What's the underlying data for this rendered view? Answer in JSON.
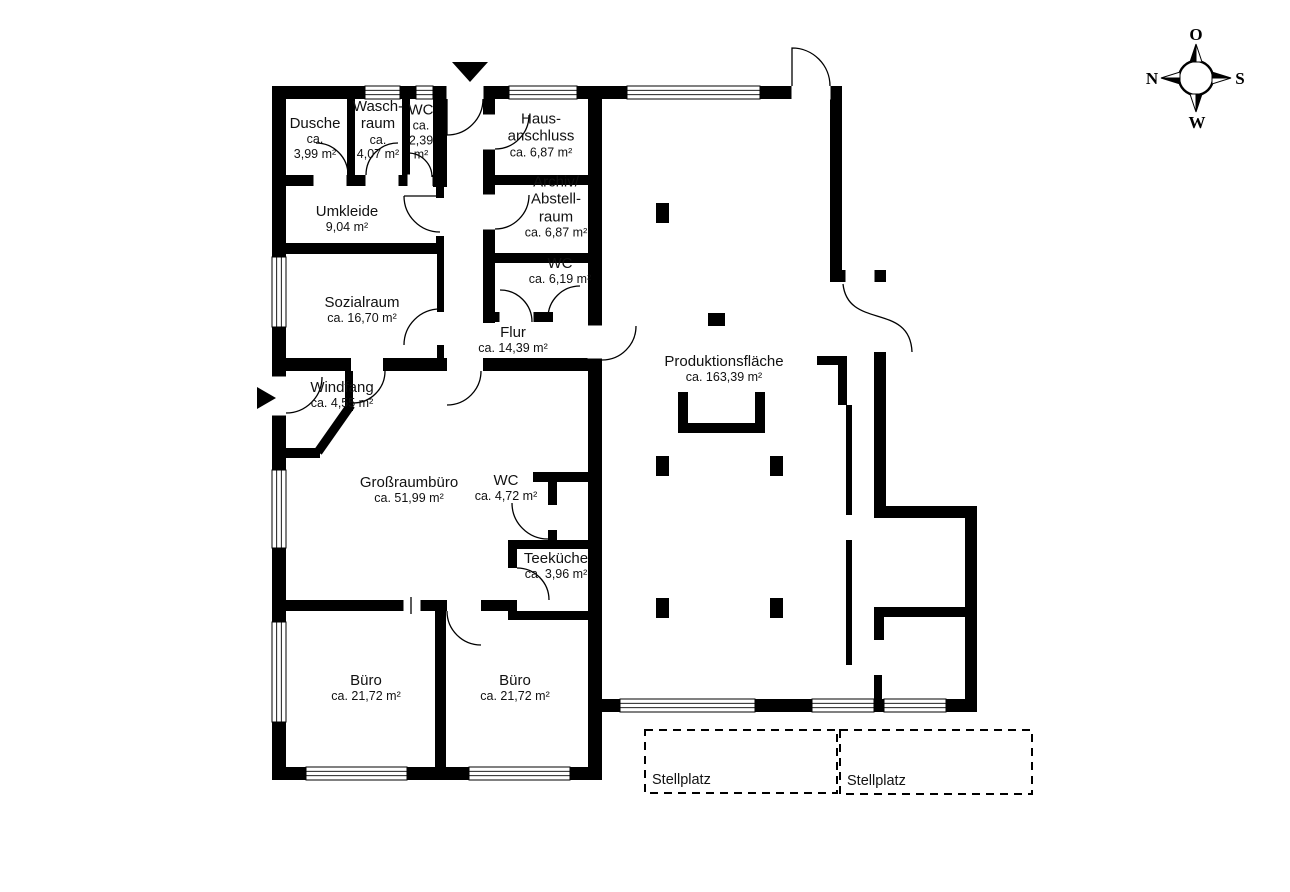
{
  "plan": {
    "colors": {
      "bg": "#ffffff",
      "wall": "#000000",
      "line": "#000000"
    },
    "walls": [
      {
        "x": 272,
        "y": 86,
        "w": 330,
        "h": 13
      },
      {
        "x": 602,
        "y": 86,
        "w": 190,
        "h": 13
      },
      {
        "x": 272,
        "y": 86,
        "w": 14,
        "h": 694
      },
      {
        "x": 272,
        "y": 767,
        "w": 330,
        "h": 13
      },
      {
        "x": 588,
        "y": 86,
        "w": 14,
        "h": 694
      },
      {
        "x": 596,
        "y": 699,
        "w": 381,
        "h": 13
      },
      {
        "x": 830,
        "y": 86,
        "w": 12,
        "h": 196
      },
      {
        "x": 830,
        "y": 270,
        "w": 56,
        "h": 12
      },
      {
        "x": 874,
        "y": 352,
        "w": 12,
        "h": 166
      },
      {
        "x": 874,
        "y": 506,
        "w": 103,
        "h": 12
      },
      {
        "x": 965,
        "y": 506,
        "w": 12,
        "h": 206
      },
      {
        "x": 347,
        "y": 99,
        "w": 8,
        "h": 76
      },
      {
        "x": 402,
        "y": 99,
        "w": 8,
        "h": 76
      },
      {
        "x": 433,
        "y": 99,
        "w": 14,
        "h": 88
      },
      {
        "x": 272,
        "y": 175,
        "w": 175,
        "h": 11
      },
      {
        "x": 483,
        "y": 99,
        "w": 12,
        "h": 224
      },
      {
        "x": 495,
        "y": 175,
        "w": 93,
        "h": 10
      },
      {
        "x": 483,
        "y": 253,
        "w": 105,
        "h": 10
      },
      {
        "x": 483,
        "y": 312,
        "w": 70,
        "h": 10
      },
      {
        "x": 436,
        "y": 186,
        "w": 8,
        "h": 12
      },
      {
        "x": 436,
        "y": 236,
        "w": 8,
        "h": 18
      },
      {
        "x": 272,
        "y": 243,
        "w": 170,
        "h": 11
      },
      {
        "x": 437,
        "y": 254,
        "w": 7,
        "h": 58
      },
      {
        "x": 437,
        "y": 345,
        "w": 7,
        "h": 16
      },
      {
        "x": 272,
        "y": 358,
        "w": 79,
        "h": 13
      },
      {
        "x": 383,
        "y": 358,
        "w": 64,
        "h": 13
      },
      {
        "x": 483,
        "y": 358,
        "w": 119,
        "h": 13
      },
      {
        "x": 345,
        "y": 371,
        "w": 8,
        "h": 40
      },
      {
        "x": 286,
        "y": 448,
        "w": 34,
        "h": 10
      },
      {
        "x": 533,
        "y": 472,
        "w": 69,
        "h": 10
      },
      {
        "x": 548,
        "y": 472,
        "w": 9,
        "h": 33
      },
      {
        "x": 548,
        "y": 530,
        "w": 9,
        "h": 12
      },
      {
        "x": 508,
        "y": 540,
        "w": 94,
        "h": 9
      },
      {
        "x": 508,
        "y": 549,
        "w": 9,
        "h": 19
      },
      {
        "x": 508,
        "y": 600,
        "w": 9,
        "h": 20
      },
      {
        "x": 508,
        "y": 611,
        "w": 94,
        "h": 9
      },
      {
        "x": 286,
        "y": 600,
        "w": 161,
        "h": 11
      },
      {
        "x": 481,
        "y": 600,
        "w": 35,
        "h": 11
      },
      {
        "x": 435,
        "y": 611,
        "w": 11,
        "h": 156
      },
      {
        "x": 678,
        "y": 392,
        "w": 10,
        "h": 41
      },
      {
        "x": 678,
        "y": 423,
        "w": 87,
        "h": 10
      },
      {
        "x": 755,
        "y": 392,
        "w": 10,
        "h": 41
      },
      {
        "x": 817,
        "y": 356,
        "w": 30,
        "h": 9
      },
      {
        "x": 838,
        "y": 356,
        "w": 9,
        "h": 49
      },
      {
        "x": 846,
        "y": 405,
        "w": 6,
        "h": 110
      },
      {
        "x": 846,
        "y": 540,
        "w": 6,
        "h": 125
      },
      {
        "x": 874,
        "y": 607,
        "w": 103,
        "h": 10
      },
      {
        "x": 874,
        "y": 617,
        "w": 10,
        "h": 23
      },
      {
        "x": 874,
        "y": 675,
        "w": 8,
        "h": 26
      }
    ],
    "diagonal_walls": [
      {
        "x1": 351,
        "y1": 405,
        "x2": 318,
        "y2": 452,
        "t": 9
      }
    ],
    "openings": [
      {
        "x": 447,
        "y": 86,
        "w": 36,
        "h": 13
      },
      {
        "x": 792,
        "y": 86,
        "w": 38,
        "h": 13
      },
      {
        "x": 272,
        "y": 377,
        "w": 14,
        "h": 38
      },
      {
        "x": 588,
        "y": 326,
        "w": 14,
        "h": 32
      },
      {
        "x": 846,
        "y": 270,
        "w": 28,
        "h": 12
      },
      {
        "x": 314,
        "y": 175,
        "w": 32,
        "h": 11
      },
      {
        "x": 366,
        "y": 175,
        "w": 32,
        "h": 11
      },
      {
        "x": 408,
        "y": 175,
        "w": 24,
        "h": 11
      },
      {
        "x": 483,
        "y": 115,
        "w": 12,
        "h": 34
      },
      {
        "x": 483,
        "y": 195,
        "w": 12,
        "h": 34
      },
      {
        "x": 500,
        "y": 312,
        "w": 33,
        "h": 10
      },
      {
        "x": 404,
        "y": 600,
        "w": 16,
        "h": 11
      }
    ],
    "windows": [
      {
        "x": 365,
        "y": 86,
        "w": 35,
        "h": 13,
        "dir": "h"
      },
      {
        "x": 416,
        "y": 86,
        "w": 17,
        "h": 13,
        "dir": "h"
      },
      {
        "x": 509,
        "y": 86,
        "w": 68,
        "h": 13,
        "dir": "h"
      },
      {
        "x": 627,
        "y": 86,
        "w": 133,
        "h": 13,
        "dir": "h"
      },
      {
        "x": 272,
        "y": 257,
        "w": 14,
        "h": 70,
        "dir": "v"
      },
      {
        "x": 272,
        "y": 470,
        "w": 14,
        "h": 78,
        "dir": "v"
      },
      {
        "x": 272,
        "y": 622,
        "w": 14,
        "h": 100,
        "dir": "v"
      },
      {
        "x": 306,
        "y": 767,
        "w": 101,
        "h": 13,
        "dir": "h"
      },
      {
        "x": 469,
        "y": 767,
        "w": 101,
        "h": 13,
        "dir": "h"
      },
      {
        "x": 620,
        "y": 699,
        "w": 135,
        "h": 13,
        "dir": "h"
      },
      {
        "x": 812,
        "y": 699,
        "w": 62,
        "h": 13,
        "dir": "h"
      },
      {
        "x": 884,
        "y": 699,
        "w": 62,
        "h": 13,
        "dir": "h"
      }
    ],
    "doors": [
      {
        "d": "M 483 99 A 36 36 0 0 1 447 135 M 447 99 L 447 135"
      },
      {
        "d": "M 792 86 L 792 48 A 38 38 0 0 1 830 86"
      },
      {
        "d": "M 322 377 A 36 36 0 0 1 286 413"
      },
      {
        "d": "M 385 371 A 32 32 0 0 1 353 403"
      },
      {
        "d": "M 348 175 A 32 32 0 0 0 316 143"
      },
      {
        "d": "M 398 143 A 32 32 0 0 0 366 175"
      },
      {
        "d": "M 408 153 A 24 24 0 0 1 432 177"
      },
      {
        "d": "M 404 196 A 36 36 0 0 0 440 232 M 404 196 L 440 196"
      },
      {
        "d": "M 440 309 A 36 36 0 0 0 404 345"
      },
      {
        "d": "M 495 149 A 34 34 0 0 0 529 115"
      },
      {
        "d": "M 495 229 A 34 34 0 0 0 529 195"
      },
      {
        "d": "M 500 290 A 32 32 0 0 1 532 322"
      },
      {
        "d": "M 580 286 A 32 32 0 0 0 548 318"
      },
      {
        "d": "M 481 371 A 34 34 0 0 1 447 405"
      },
      {
        "d": "M 636 326 A 34 34 0 0 1 602 360"
      },
      {
        "d": "M 843 284 C 848 330 910 302 912 352"
      },
      {
        "d": "M 512 503 A 36 36 0 0 0 548 539"
      },
      {
        "d": "M 517 568 A 32 32 0 0 1 549 600"
      },
      {
        "d": "M 447 611 A 34 34 0 0 0 481 645"
      },
      {
        "d": "M 411 597 L 411 614"
      }
    ],
    "columns": [
      {
        "x": 656,
        "y": 203,
        "w": 13,
        "h": 20
      },
      {
        "x": 708,
        "y": 313,
        "w": 17,
        "h": 13
      },
      {
        "x": 656,
        "y": 456,
        "w": 13,
        "h": 20
      },
      {
        "x": 770,
        "y": 456,
        "w": 13,
        "h": 20
      },
      {
        "x": 656,
        "y": 598,
        "w": 13,
        "h": 20
      },
      {
        "x": 770,
        "y": 598,
        "w": 13,
        "h": 20
      }
    ],
    "entrance_arrows": [
      {
        "points": "452,62 488,62 470,82"
      },
      {
        "points": "257,387 276,398 257,409"
      }
    ],
    "stellplatz": [
      {
        "x": 645,
        "y": 730,
        "w": 192,
        "h": 63,
        "label": "Stellplatz"
      },
      {
        "x": 840,
        "y": 730,
        "w": 192,
        "h": 64,
        "label": "Stellplatz"
      }
    ]
  },
  "rooms": [
    {
      "id": "dusche",
      "cx": 315,
      "cy": 138,
      "name": [
        "Dusche"
      ],
      "area": [
        "ca.",
        "3,99 m²"
      ]
    },
    {
      "id": "waschraum",
      "cx": 378,
      "cy": 130,
      "name": [
        "Wasch-",
        "raum"
      ],
      "area": [
        "ca.",
        "4,07 m²"
      ]
    },
    {
      "id": "wc-klein",
      "cx": 421,
      "cy": 132,
      "name": [
        "WC"
      ],
      "area": [
        "ca.",
        "2,39",
        "m²"
      ]
    },
    {
      "id": "hausanschluss",
      "cx": 541,
      "cy": 135,
      "name": [
        "Haus-",
        "anschluss"
      ],
      "area": [
        "ca. 6,87 m²"
      ]
    },
    {
      "id": "archiv-abstellraum",
      "cx": 556,
      "cy": 207,
      "name": [
        "Archiv/",
        "Abstell-",
        "raum"
      ],
      "area": [
        "ca. 6,87 m²"
      ]
    },
    {
      "id": "wc-619",
      "cx": 560,
      "cy": 271,
      "name": [
        "WC"
      ],
      "area": [
        "ca. 6,19 m²"
      ]
    },
    {
      "id": "umkleide",
      "cx": 347,
      "cy": 219,
      "name": [
        "Umkleide"
      ],
      "area": [
        "9,04 m²"
      ]
    },
    {
      "id": "sozialraum",
      "cx": 362,
      "cy": 310,
      "name": [
        "Sozialraum"
      ],
      "area": [
        "ca. 16,70 m²"
      ]
    },
    {
      "id": "windfang",
      "cx": 342,
      "cy": 395,
      "name": [
        "Windfang"
      ],
      "area": [
        "ca. 4,55 m²"
      ]
    },
    {
      "id": "flur",
      "cx": 513,
      "cy": 340,
      "name": [
        "Flur"
      ],
      "area": [
        "ca. 14,39 m²"
      ]
    },
    {
      "id": "grossraumbuero",
      "cx": 409,
      "cy": 490,
      "name": [
        "Großraumbüro"
      ],
      "area": [
        "ca. 51,99 m²"
      ]
    },
    {
      "id": "wc-472",
      "cx": 506,
      "cy": 488,
      "name": [
        "WC"
      ],
      "area": [
        "ca. 4,72 m²"
      ]
    },
    {
      "id": "teekueche",
      "cx": 556,
      "cy": 566,
      "name": [
        "Teeküche"
      ],
      "area": [
        "ca. 3,96 m²"
      ]
    },
    {
      "id": "buero-links",
      "cx": 366,
      "cy": 688,
      "name": [
        "Büro"
      ],
      "area": [
        "ca. 21,72 m²"
      ]
    },
    {
      "id": "buero-rechts",
      "cx": 515,
      "cy": 688,
      "name": [
        "Büro"
      ],
      "area": [
        "ca. 21,72 m²"
      ]
    },
    {
      "id": "produktionsflaeche",
      "cx": 724,
      "cy": 369,
      "name": [
        "Produktionsfläche"
      ],
      "area": [
        "ca. 163,39 m²"
      ]
    }
  ],
  "compass": {
    "cx": 1196,
    "cy": 78,
    "r": 17,
    "directions": [
      {
        "label": "O",
        "x": 1196,
        "y": 40
      },
      {
        "label": "S",
        "x": 1240,
        "y": 84
      },
      {
        "label": "W",
        "x": 1197,
        "y": 128
      },
      {
        "label": "N",
        "x": 1152,
        "y": 84
      }
    ],
    "spikes": [
      {
        "pts": "1196,44 1190,62 1196,62",
        "fill": "#000000"
      },
      {
        "pts": "1196,44 1202,62 1196,62",
        "fill": "#ffffff"
      },
      {
        "pts": "1231,78 1212,72 1212,78",
        "fill": "#000000"
      },
      {
        "pts": "1231,78 1212,84 1212,78",
        "fill": "#ffffff"
      },
      {
        "pts": "1196,112 1202,94 1196,94",
        "fill": "#000000"
      },
      {
        "pts": "1196,112 1190,94 1196,94",
        "fill": "#ffffff"
      },
      {
        "pts": "1161,78 1180,84 1180,78",
        "fill": "#000000"
      },
      {
        "pts": "1161,78 1180,72 1180,78",
        "fill": "#ffffff"
      }
    ]
  }
}
